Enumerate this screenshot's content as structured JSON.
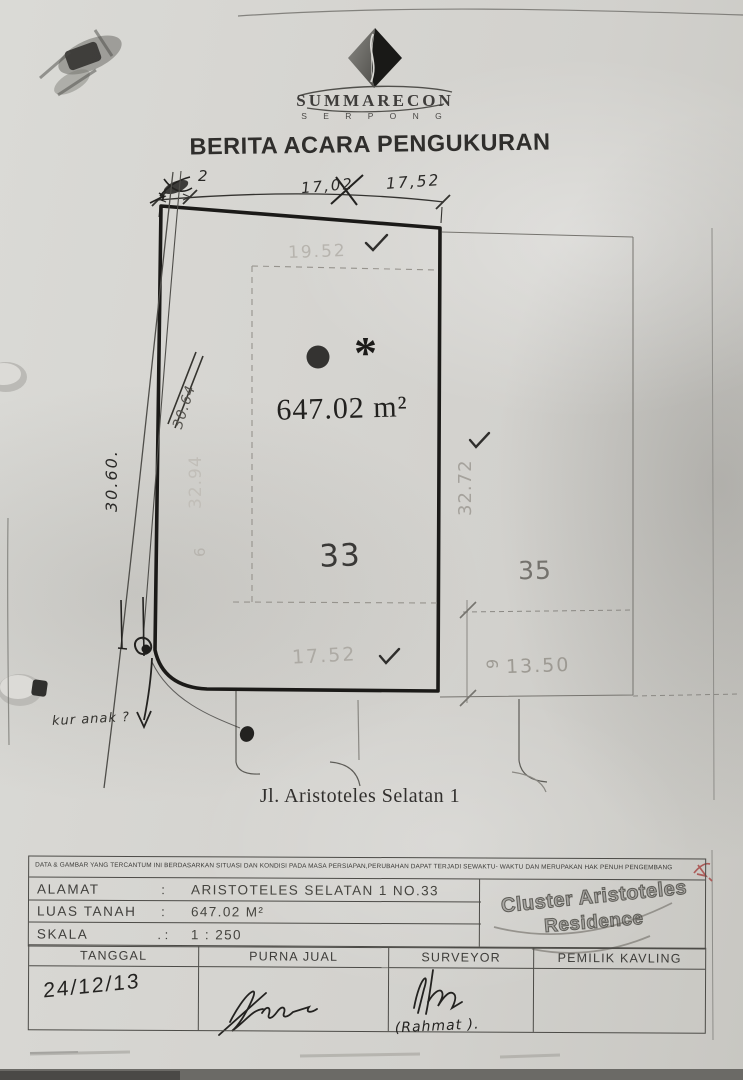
{
  "document": {
    "brand": "SUMMARECON",
    "brand_sub": "S E R P O N G",
    "title": "BERITA ACARA PENGUKURAN"
  },
  "plot": {
    "handwritten_corner_note": "2",
    "handwritten_dim_old": "17,02",
    "handwritten_dim_new": "17,52",
    "top_setback_dim": "19.52",
    "left_handwritten_dim": "30.60.",
    "left_crossed_dim": "30.64",
    "left_setback_dim": "32.94",
    "left_setback_sub": "6",
    "right_dim": "32.72",
    "area_label": "647.02 m²",
    "asterisk": "*",
    "plot_number": "33",
    "neighbor_number": "35",
    "bottom_dim": "17.52",
    "neighbor_depth": "9",
    "neighbor_width": "13.50",
    "street_label": "Jl. Aristoteles Selatan 1",
    "margin_note": "kur anak ?"
  },
  "disclaimer": "DATA & GAMBAR YANG TERCANTUM INI BERDASARKAN SITUASI DAN KONDISI PADA MASA PERSIAPAN,PERUBAHAN DAPAT TERJADI SEWAKTU- WAKTU DAN MERUPAKAN HAK PENUH PENGEMBANG",
  "info": {
    "rows": [
      {
        "label": "ALAMAT",
        "sep": ":",
        "value": "ARISTOTELES  SELATAN  1  NO.33"
      },
      {
        "label": "LUAS  TANAH",
        "sep": ":",
        "value": "647.02  M²"
      },
      {
        "label": "SKALA",
        "sep": ".  :",
        "value": "1  :  250"
      }
    ],
    "stamp": {
      "line1": "Cluster Aristoteles",
      "line2": "Residence"
    }
  },
  "signoff": {
    "headers": [
      "TANGGAL",
      "PURNA  JUAL",
      "SURVEYOR",
      "PEMILIK  KAVLING"
    ],
    "date": "24/12/13",
    "surveyor_name": "(Rahmat )."
  },
  "colors": {
    "paper": "#d6d5d1",
    "ink": "#2a2928",
    "faint_print": "#b0ada8",
    "red_mark": "#a8504c"
  }
}
